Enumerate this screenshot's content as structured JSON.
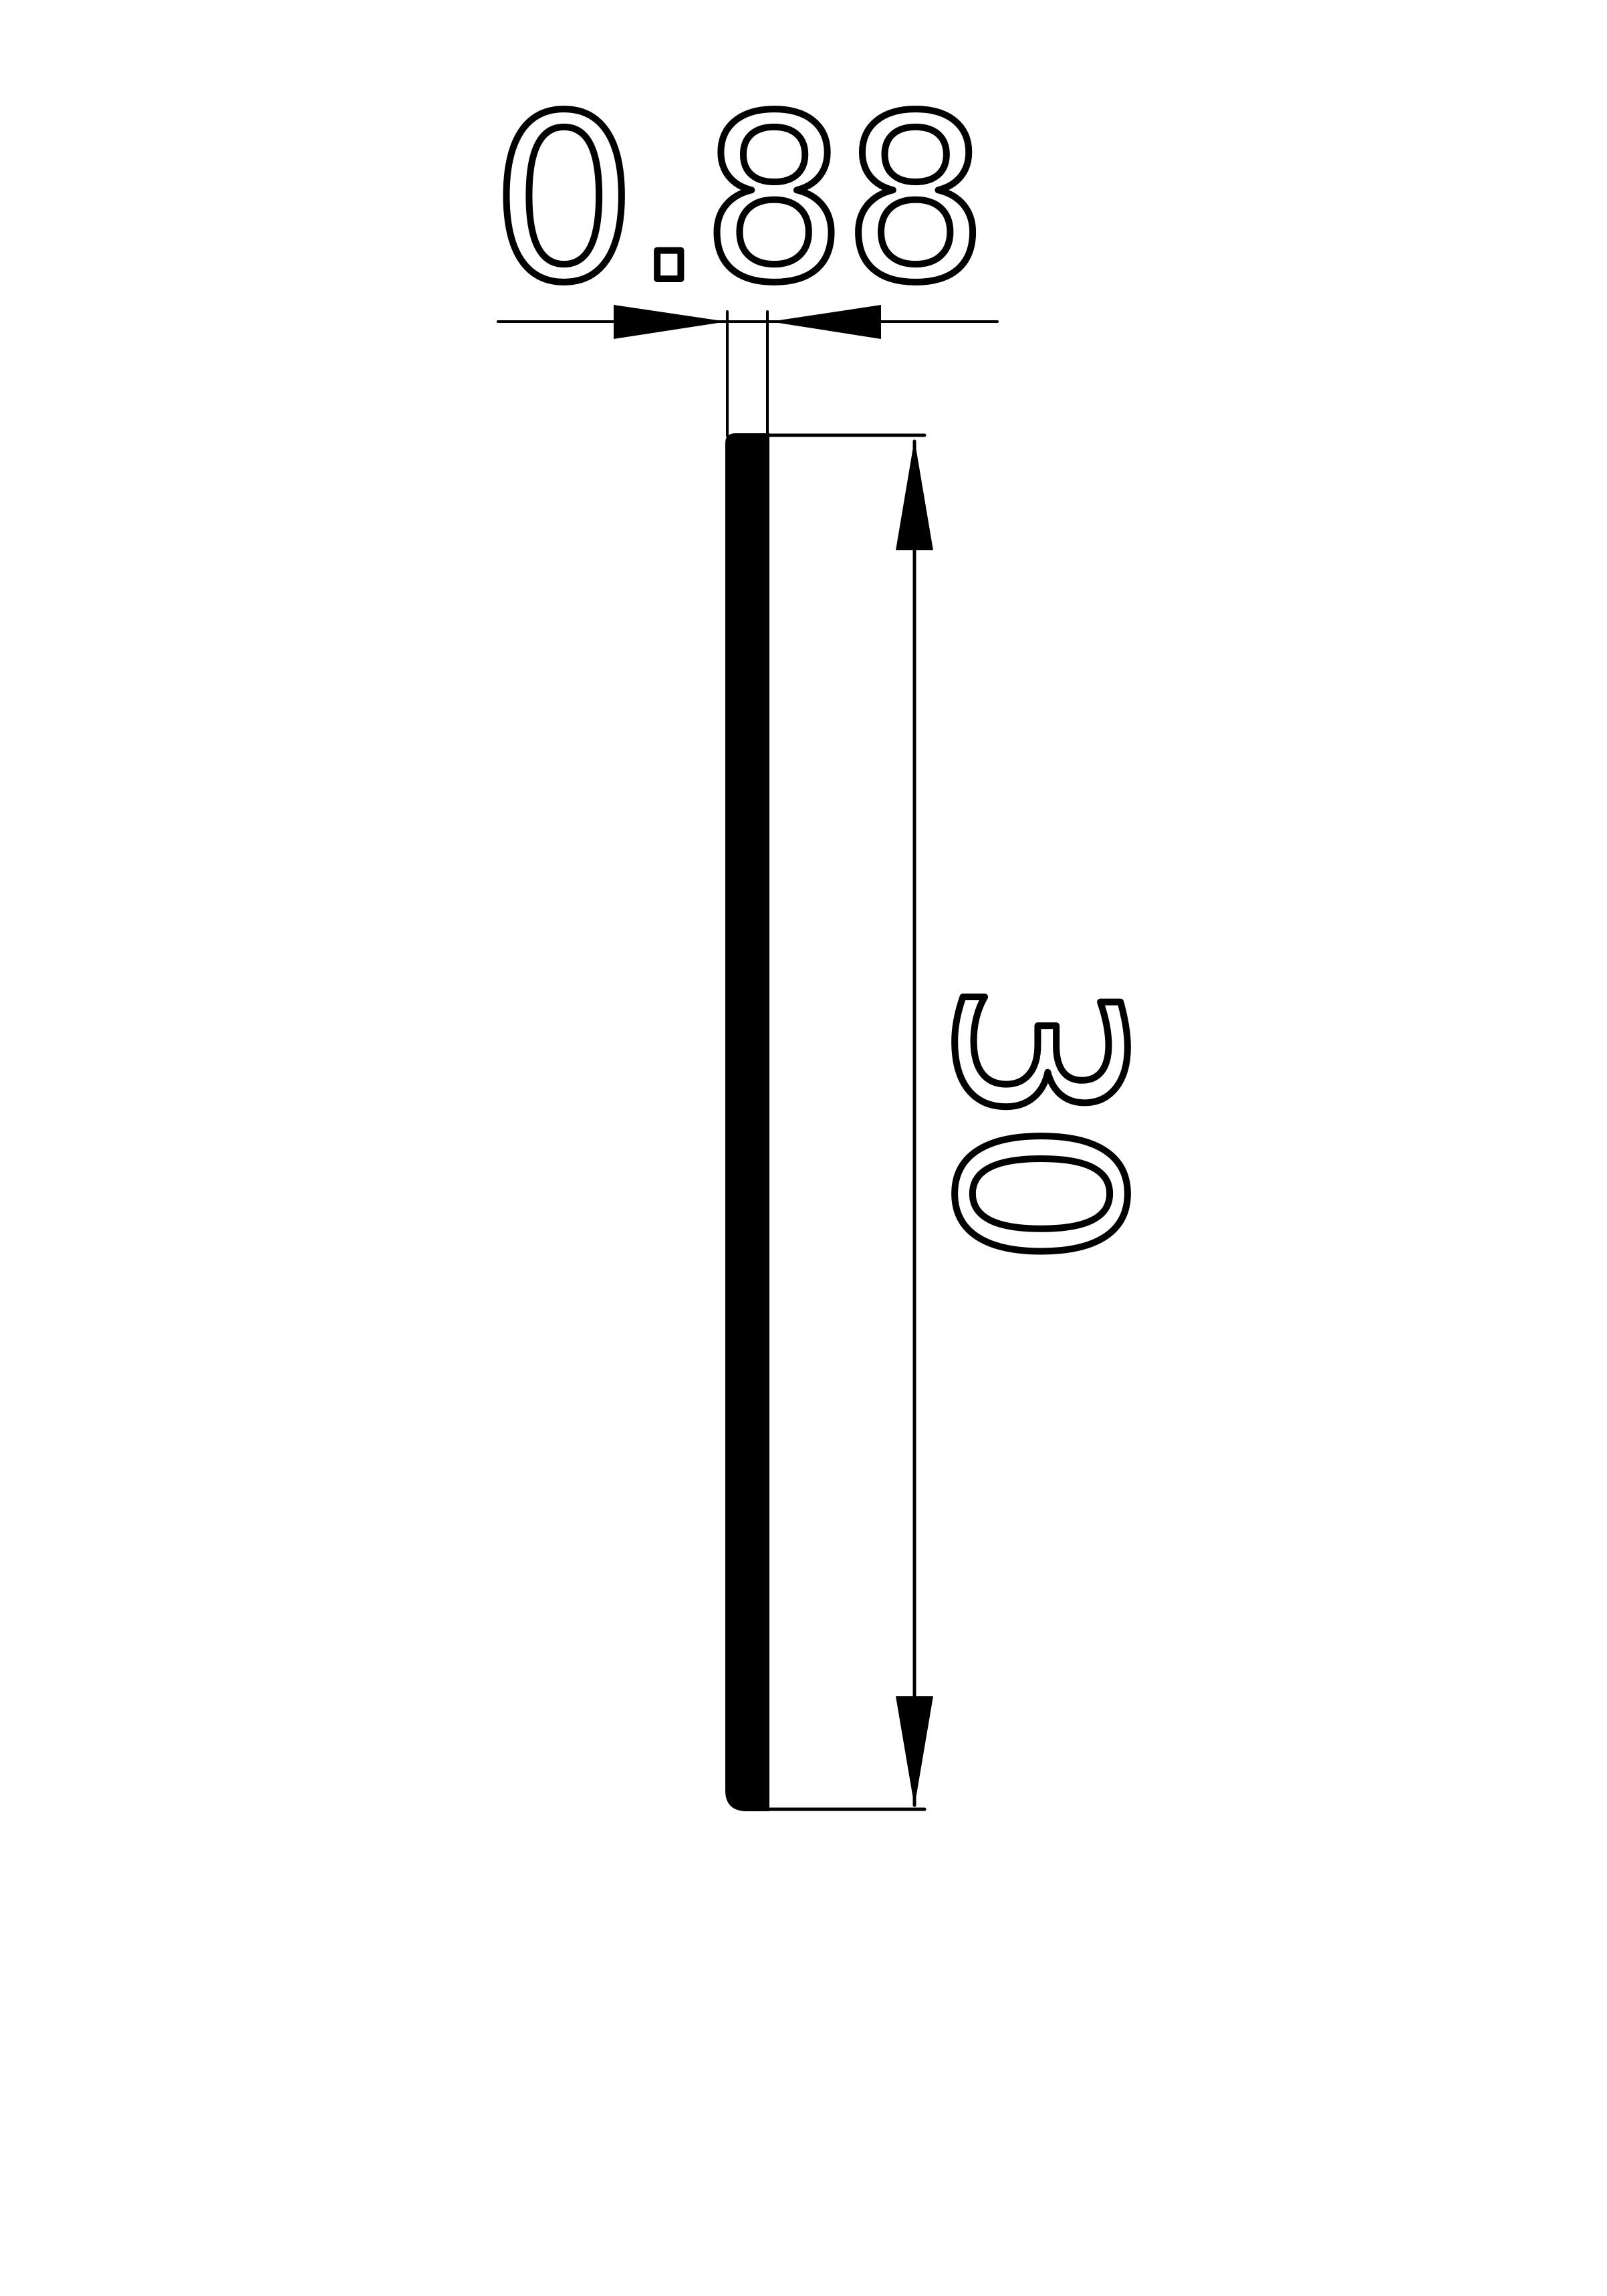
{
  "page": {
    "background": "#ffffff"
  },
  "drawing": {
    "ink_color": "#000000",
    "fill_gap_color": "#ffffff",
    "width_dimension": {
      "value": "0.88",
      "orientation": "horizontal"
    },
    "height_dimension": {
      "value": "30",
      "orientation": "vertical"
    }
  }
}
